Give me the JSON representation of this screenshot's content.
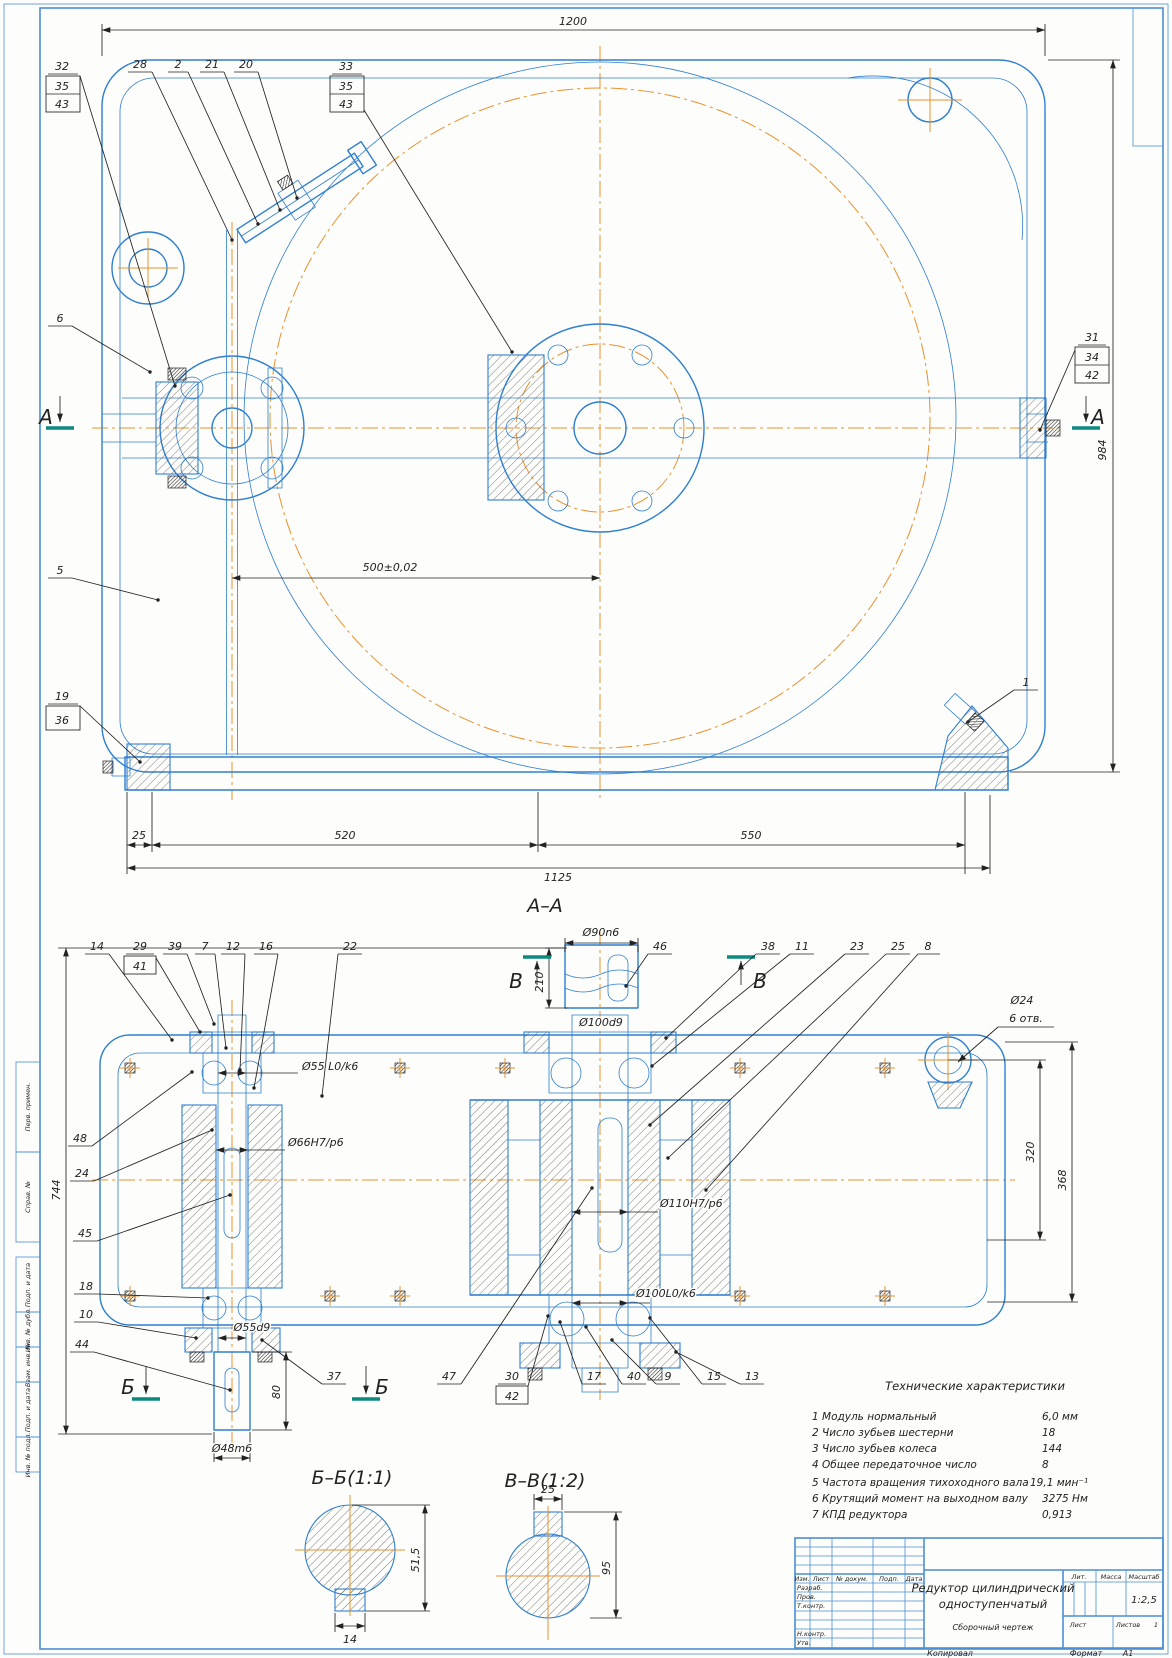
{
  "palette": {
    "line_blue": "#2e7fd0",
    "centerline_orange": "#e8922e",
    "dim_black": "#222222",
    "section_teal": "#0d8a80",
    "frame_blue": "#4a8fd4"
  },
  "frame": {
    "left_labels": [
      "Перв. примен.",
      "Справ. №",
      "Подп. и дата",
      "Инв. № дубл.",
      "Взам. инв. №",
      "Подп. и дата",
      "Инв. № подл."
    ],
    "footer": {
      "copied": "Копировал",
      "format_label": "Формат",
      "format_value": "А1"
    }
  },
  "top_view": {
    "section_mark": "А",
    "dims": {
      "overall_width": "1200",
      "overall_height": "984",
      "center_distance": "500±0,02",
      "foot_offset": "25",
      "span_left": "520",
      "span_right": "550",
      "base_length": "1125"
    },
    "callout_boxes": {
      "b32": [
        "32",
        "35",
        "43"
      ],
      "b33": [
        "33",
        "35",
        "43"
      ],
      "b31": [
        "31",
        "34",
        "42"
      ],
      "b19": [
        "19",
        "36"
      ]
    },
    "callouts": {
      "c28": "28",
      "c2": "2",
      "c21": "21",
      "c20": "20",
      "c6": "6",
      "c5": "5",
      "c1": "1"
    }
  },
  "section_view": {
    "label": "А–А",
    "marks": {
      "b": "Б",
      "v": "В"
    },
    "callouts": {
      "c14": "14",
      "c39": "39",
      "c7": "7",
      "c12": "12",
      "c16": "16",
      "c22": "22",
      "c46": "46",
      "c38": "38",
      "c11": "11",
      "c23": "23",
      "c25": "25",
      "c8": "8",
      "c48": "48",
      "c24": "24",
      "c45": "45",
      "c18": "18",
      "c10": "10",
      "c44": "44",
      "c37": "37",
      "c47": "47",
      "c17": "17",
      "c40": "40",
      "c9": "9",
      "c15": "15",
      "c13": "13"
    },
    "callout_boxes": {
      "b29": [
        "29",
        "41"
      ],
      "b30": [
        "30",
        "42"
      ]
    },
    "dims": {
      "coupling_dia": "Ø90n6",
      "coupling_len": "210",
      "seat_dia": "Ø100d9",
      "bearing_fit_in": "Ø55 L0/k6",
      "gear_fit_in": "Ø66H7/p6",
      "wheel_fit": "Ø110H7/p6",
      "bearing_fit_out": "Ø100L0/k6",
      "seal_dia": "Ø55d9",
      "shaft_end_len": "80",
      "shaft_end_dia": "Ø48m6",
      "height": "744",
      "bore_height": "320",
      "wall_height": "368",
      "hole_dia": "Ø24",
      "hole_count": "6 отв."
    }
  },
  "detail_bb": {
    "label": "Б–Б(1:1)",
    "dims": {
      "across": "51,5",
      "key": "14"
    }
  },
  "detail_vv": {
    "label": "В–В(1:2)",
    "dims": {
      "key": "25",
      "across": "95"
    }
  },
  "tech": {
    "title": "Технические характеристики",
    "rows": [
      {
        "name": "1 Модуль нормальный",
        "value": "6,0 мм"
      },
      {
        "name": "2 Число зубьев шестерни",
        "value": "18"
      },
      {
        "name": "3 Число зубьев колеса",
        "value": "144"
      },
      {
        "name": "4 Общее передаточное число",
        "value": "8"
      },
      {
        "name": "5 Частота вращения тихоходного вала",
        "value": "19,1 мин⁻¹"
      },
      {
        "name": "6 Крутящий момент на выходном валу",
        "value": "3275 Нм"
      },
      {
        "name": "7 КПД редуктора",
        "value": "0,913"
      }
    ]
  },
  "title_block": {
    "doc_title_line1": "Редуктор цилиндрический",
    "doc_title_line2": "одноступенчатый",
    "doc_type": "Сборочный чертеж",
    "headers": [
      "Изм.",
      "Лист",
      "№ докум.",
      "Подп.",
      "Дата"
    ],
    "roles": [
      "Разраб.",
      "Пров.",
      "Т.контр.",
      "Н.контр.",
      "Утв."
    ],
    "lit": "Лит.",
    "massa": "Масса",
    "scale_label": "Масштаб",
    "scale": "1:2,5",
    "sheet_label": "Лист",
    "sheets_label": "Листов",
    "sheets_value": "1"
  }
}
